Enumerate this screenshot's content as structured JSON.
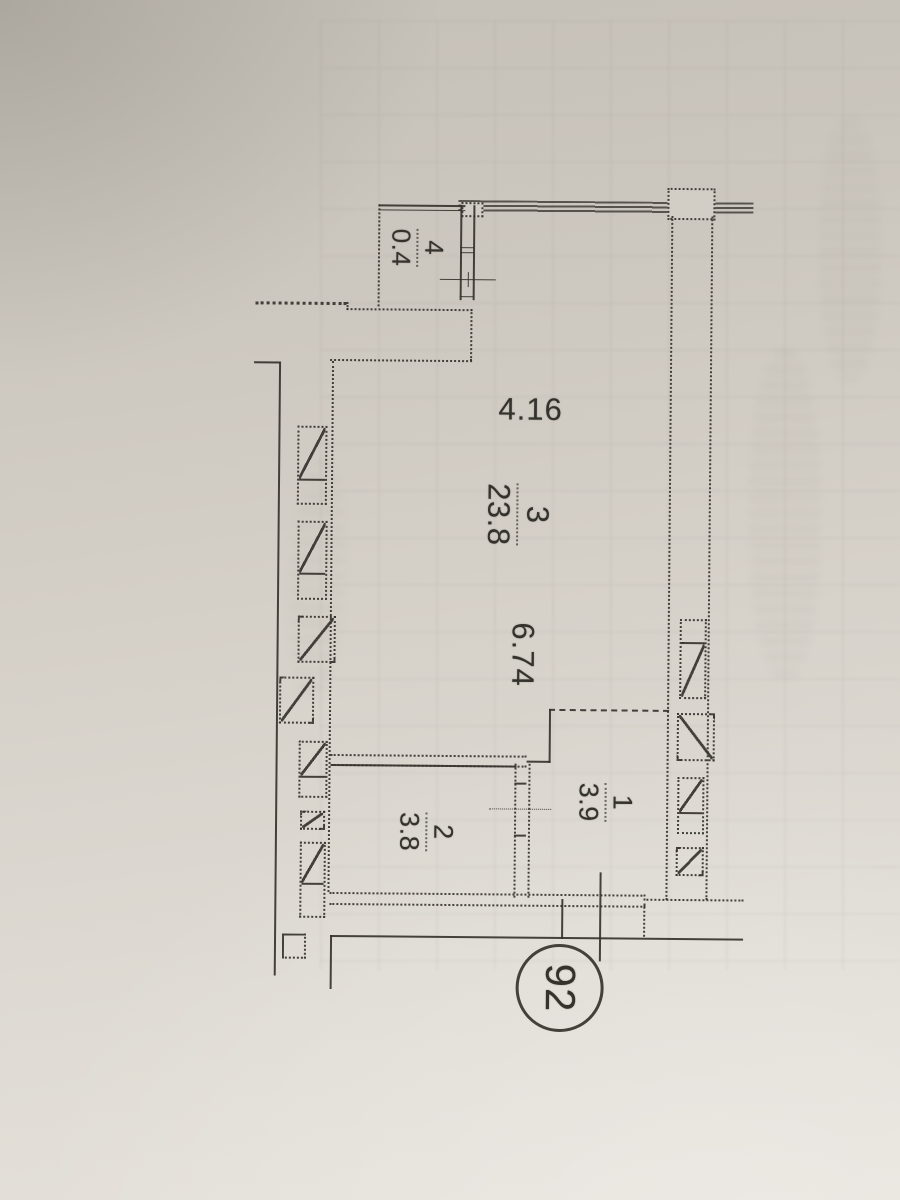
{
  "plan": {
    "apartment_number": "92",
    "rooms": [
      {
        "number": "4",
        "area": "0.4"
      },
      {
        "number": "3",
        "area": "23.8"
      },
      {
        "number": "2",
        "area": "3.8"
      },
      {
        "number": "1",
        "area": "3.9"
      }
    ],
    "dimensions": [
      {
        "value": "4.16"
      },
      {
        "value": "6.74"
      }
    ]
  }
}
